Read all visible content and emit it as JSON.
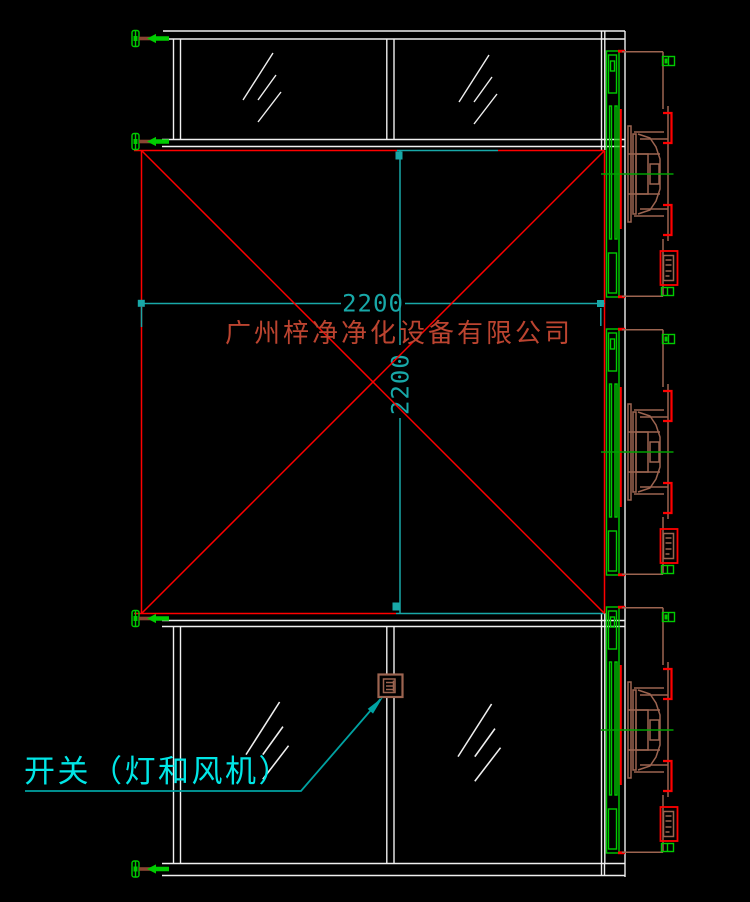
{
  "drawing": {
    "kind": "cad-plan-drawing",
    "background": "#000000",
    "watermark": {
      "text": "广州梓净净化设备有限公司",
      "color": "#bc4430"
    },
    "dimensions": {
      "width": {
        "value": "2200",
        "orientation": "horizontal"
      },
      "height": {
        "value": "2200",
        "orientation": "vertical"
      }
    },
    "annotations": {
      "switch_label": "开关（灯和风机）",
      "switch_label_color": "#00e6e6"
    },
    "colors": {
      "frame_white": "#f0f0f0",
      "chamber_red": "#ff0000",
      "dimension_cyan": "#18a8a8",
      "leader_cyan": "#00a2a2",
      "hardware_green": "#00cc00",
      "centerline_green": "#00a000",
      "equipment_brown": "#9c6450",
      "clamp_shaft_brown": "#8a4632"
    },
    "components": {
      "top_section": "glass partition with two panes",
      "middle_section": "2200 x 2200 chamber with cross bracing",
      "bottom_section": "glass partition with two panes and switch",
      "right_side": "three fan filter units on filter wall",
      "left_side": "four hinge clamps"
    }
  }
}
